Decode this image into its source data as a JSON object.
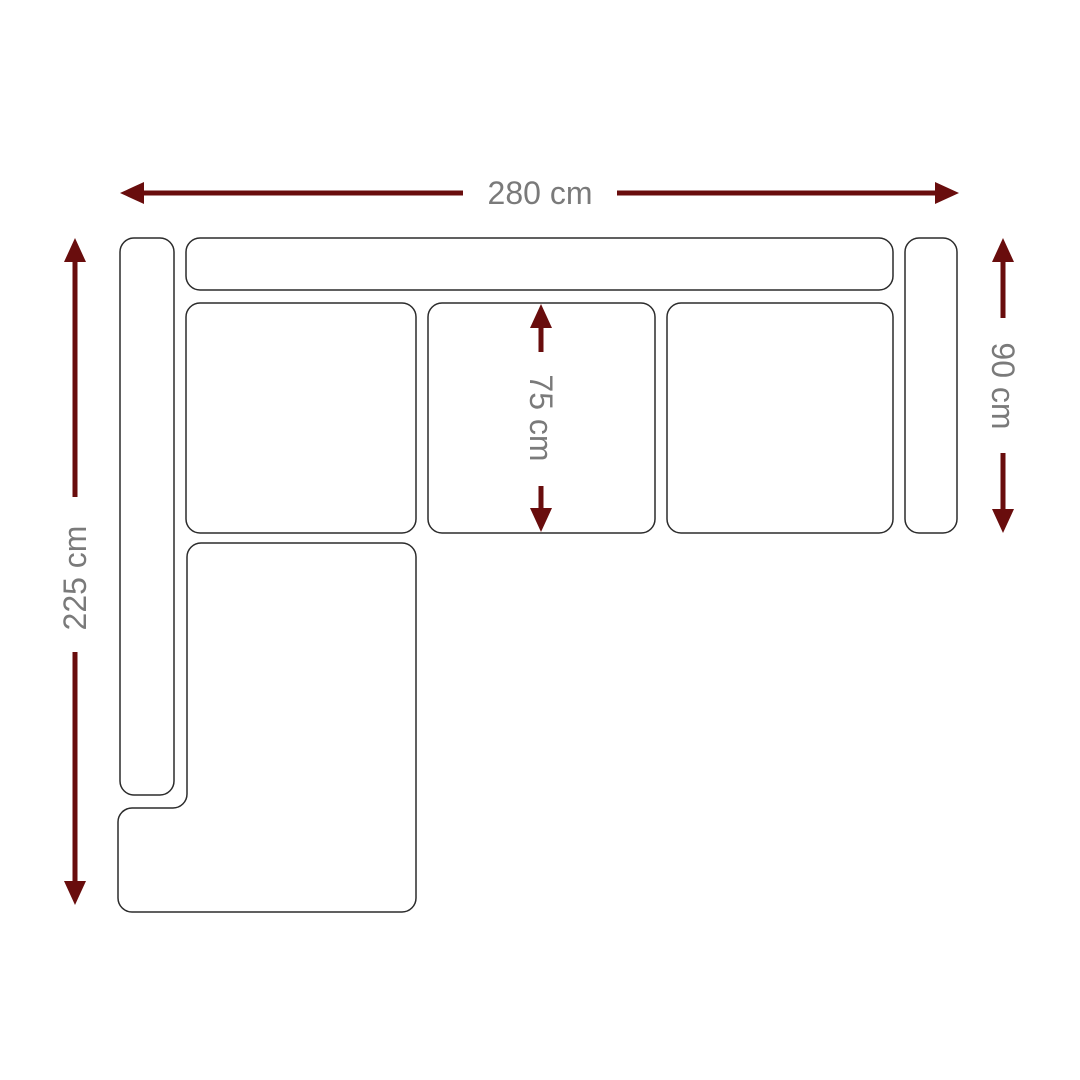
{
  "diagram": {
    "type": "sofa-top-view-dimension-drawing",
    "unit": "cm",
    "dimensions": {
      "total_width": {
        "label": "280 cm",
        "value": 280,
        "orientation": "horizontal",
        "position": "top"
      },
      "total_depth": {
        "label": "225 cm",
        "value": 225,
        "orientation": "vertical",
        "position": "left"
      },
      "sofa_depth": {
        "label": "90 cm",
        "value": 90,
        "orientation": "vertical",
        "position": "right"
      },
      "seat_depth": {
        "label": "75 cm",
        "value": 75,
        "orientation": "vertical",
        "position": "middle-seat"
      }
    },
    "colors": {
      "arrow": "#690D0D",
      "outline": "#2B2B2B",
      "label_text": "#7A7A7A",
      "background": "#FFFFFF"
    }
  }
}
